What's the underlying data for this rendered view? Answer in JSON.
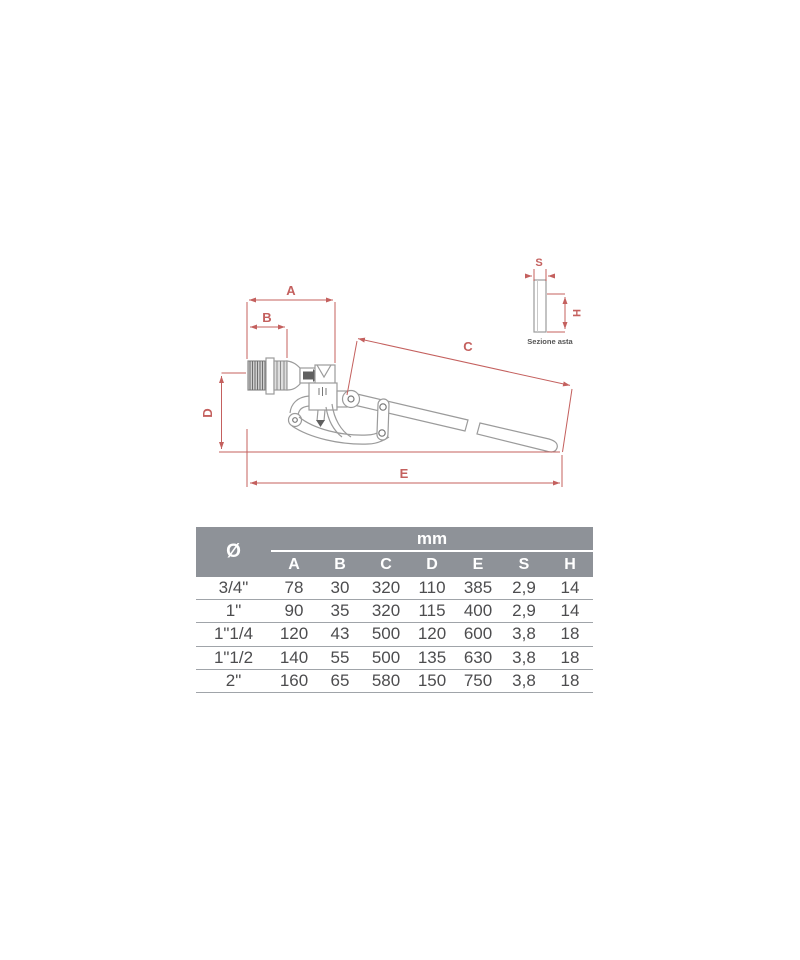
{
  "diagram": {
    "labels": {
      "A": "A",
      "B": "B",
      "C": "C",
      "D": "D",
      "E": "E",
      "S": "S",
      "H": "H"
    },
    "section_caption": "Sezione asta"
  },
  "table": {
    "diameter_symbol": "Ø",
    "unit_label": "mm",
    "columns": [
      "A",
      "B",
      "C",
      "D",
      "E",
      "S",
      "H"
    ],
    "rows": [
      {
        "size": "3/4\"",
        "A": "78",
        "B": "30",
        "C": "320",
        "D": "110",
        "E": "385",
        "S": "2,9",
        "H": "14"
      },
      {
        "size": "1\"",
        "A": "90",
        "B": "35",
        "C": "320",
        "D": "115",
        "E": "400",
        "S": "2,9",
        "H": "14"
      },
      {
        "size": "1\"1/4",
        "A": "120",
        "B": "43",
        "C": "500",
        "D": "120",
        "E": "600",
        "S": "3,8",
        "H": "18"
      },
      {
        "size": "1\"1/2",
        "A": "140",
        "B": "55",
        "C": "500",
        "D": "135",
        "E": "630",
        "S": "3,8",
        "H": "18"
      },
      {
        "size": "2\"",
        "A": "160",
        "B": "65",
        "C": "580",
        "D": "150",
        "E": "750",
        "S": "3,8",
        "H": "18"
      }
    ]
  },
  "colors": {
    "dimension_red": "#c4605e",
    "drawing_gray": "#9b9b9b",
    "table_header_gray": "#8e9298",
    "table_text": "#4d4d4f"
  }
}
